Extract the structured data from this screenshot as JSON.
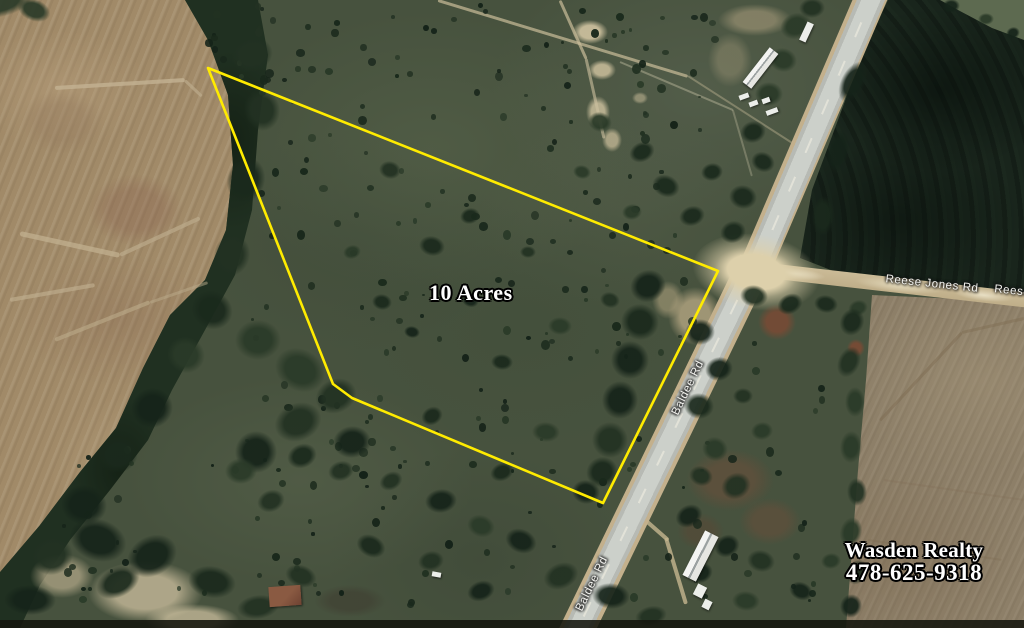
{
  "map": {
    "acreage_label": "10 Acres",
    "branding": {
      "name": "Wasden Realty",
      "phone": "478-625-9318"
    },
    "road_labels": {
      "baldee_upper": "Baldee Rd",
      "baldee_lower": "Baldee Rd",
      "reese_jones": "Reese Jones Rd",
      "reese_jones_edge": "Reese Jones Rd"
    },
    "boundary": {
      "color": "#FFEB00",
      "points": "208,68 718,271 603,503 352,398 333,384"
    }
  }
}
